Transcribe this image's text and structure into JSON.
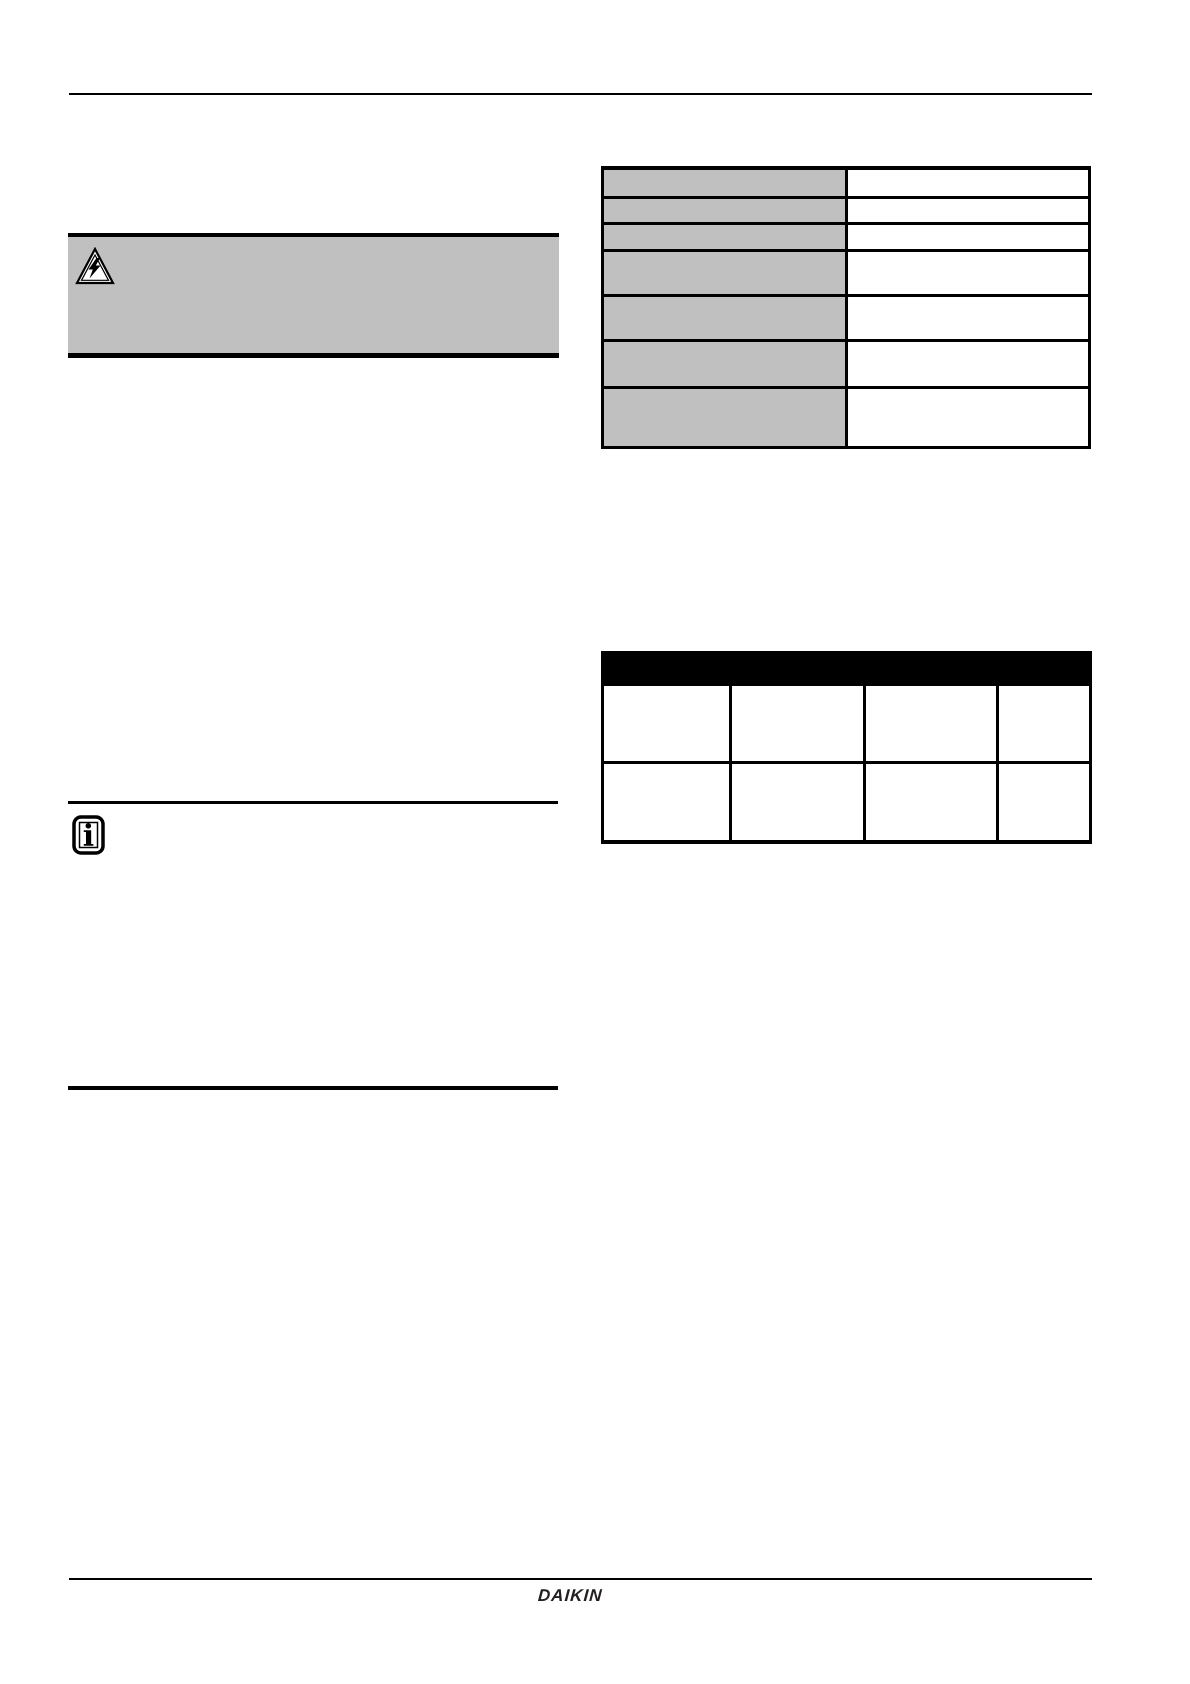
{
  "page": {
    "background_color": "#ffffff"
  },
  "colors": {
    "page_background": "#ffffff",
    "border": "#000000",
    "shaded_cell_fill": "#c0c0c0",
    "warning_box_fill": "#c0c0c0",
    "table_header_fill": "#000000",
    "logo_color": "#231f20"
  },
  "warning_box": {
    "icon": "electrical-hazard-triangle-icon",
    "content": ""
  },
  "spec_table": {
    "rows": [
      {
        "label": "",
        "value": ""
      },
      {
        "label": "",
        "value": ""
      },
      {
        "label": "",
        "value": ""
      },
      {
        "label": "",
        "value": ""
      },
      {
        "label": "",
        "value": ""
      },
      {
        "label": "",
        "value": ""
      },
      {
        "label": "",
        "value": ""
      }
    ]
  },
  "grid_table": {
    "header_cells": [
      "",
      "",
      "",
      ""
    ],
    "rows": [
      [
        "",
        "",
        "",
        ""
      ],
      [
        "",
        "",
        "",
        ""
      ]
    ]
  },
  "info_section": {
    "icon": "info-icon",
    "content": ""
  },
  "footer": {
    "logo_text": "DAIKIN"
  }
}
